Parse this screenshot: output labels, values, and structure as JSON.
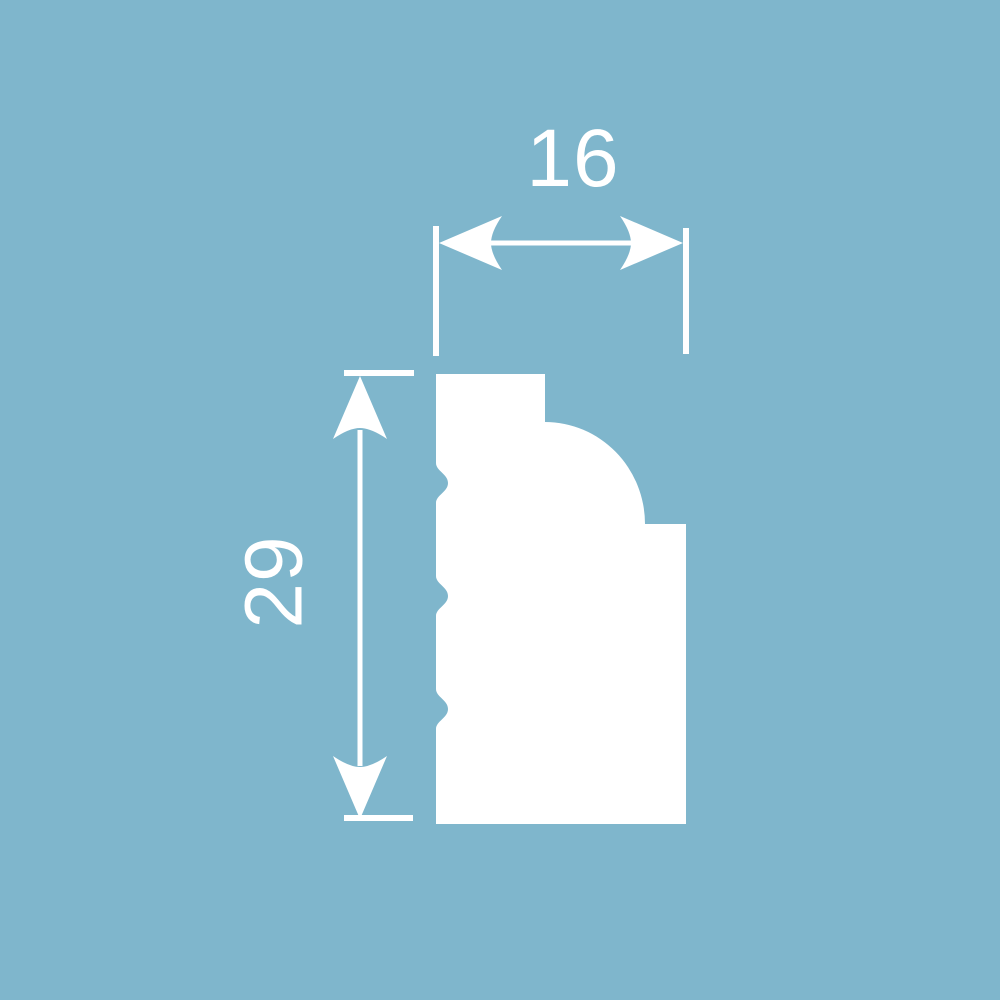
{
  "drawing": {
    "dimensions": {
      "width": {
        "value": "16"
      },
      "height": {
        "value": "29"
      }
    }
  },
  "colors": {
    "background": "#7fb6cc",
    "line": "#ffffff"
  }
}
